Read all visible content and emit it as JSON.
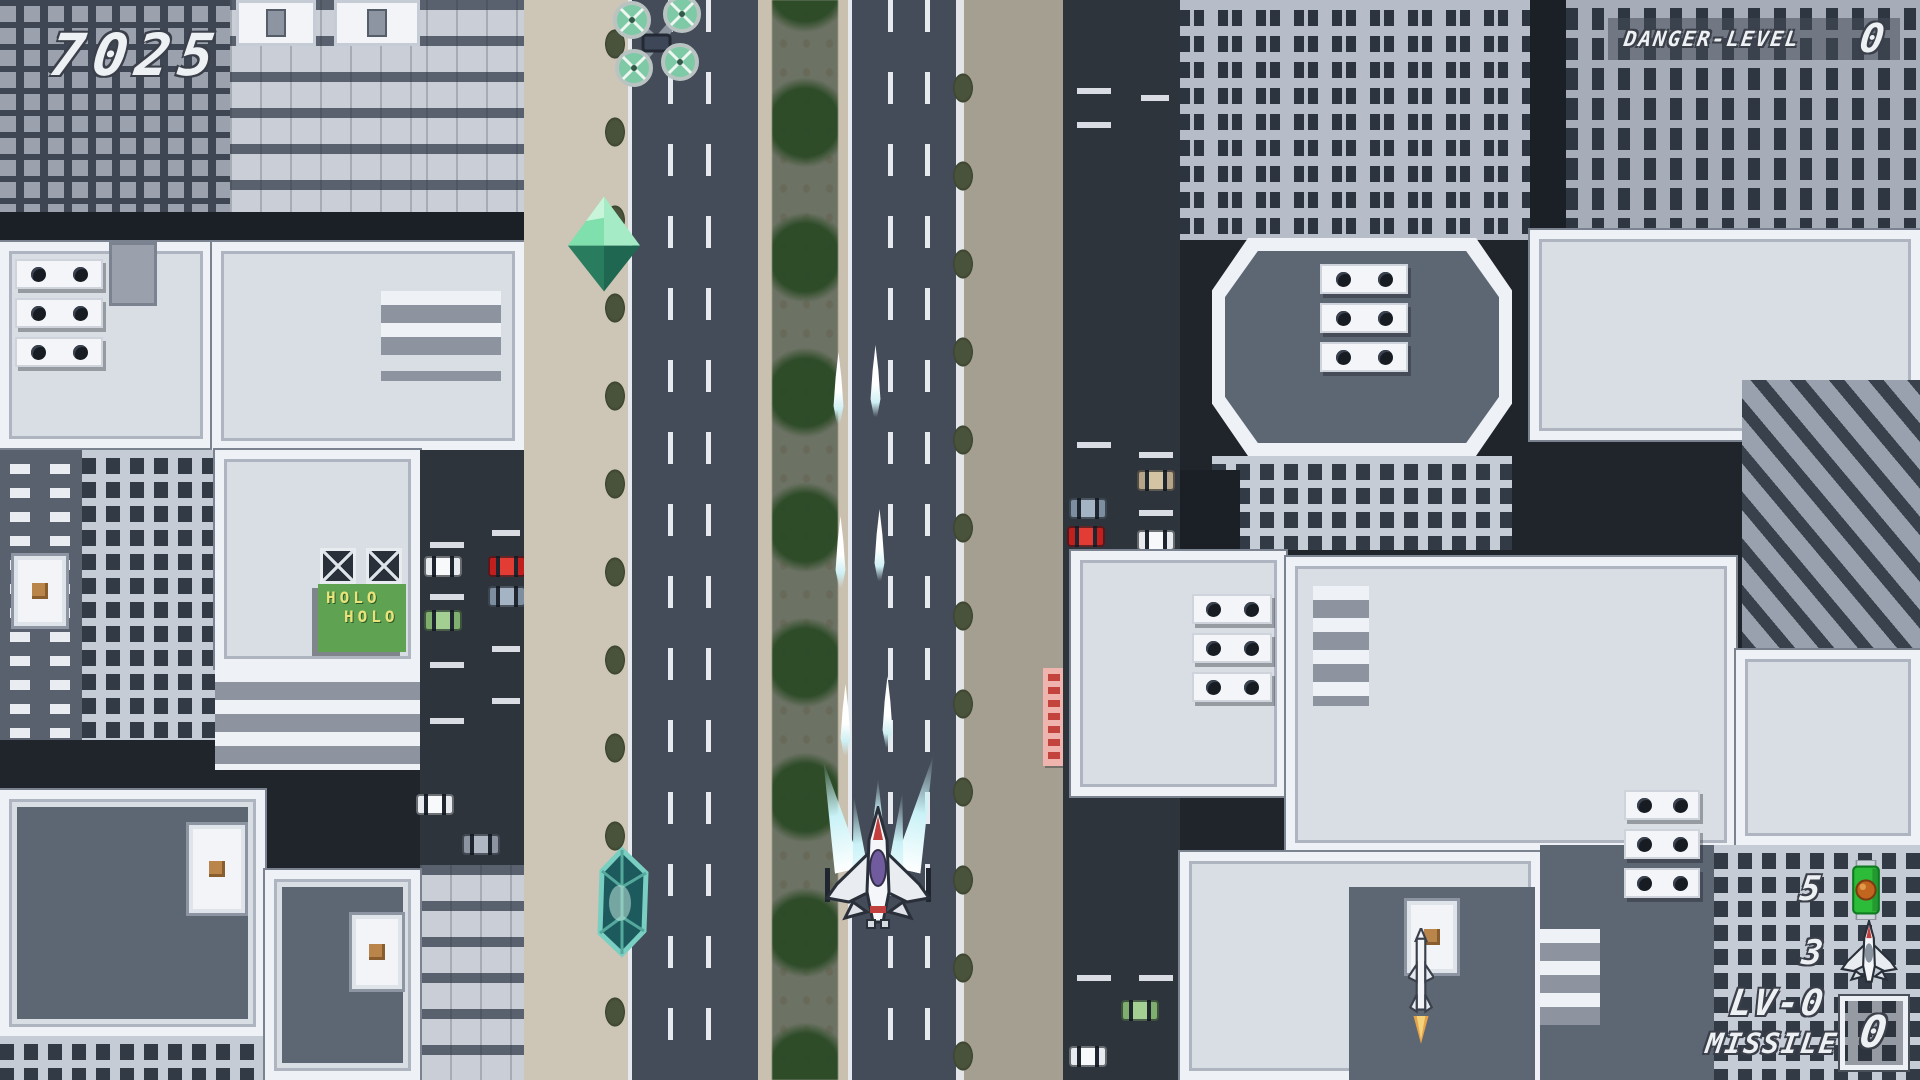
{
  "hud": {
    "score": "7025",
    "danger": {
      "label": "DANGER-LEVEL",
      "value": "0"
    },
    "bottom_right": {
      "count_top": "5",
      "count_bottom": "3",
      "level_label": "LV-0",
      "missile_label": "MISSILE",
      "missile_count": "0"
    }
  },
  "billboard": {
    "line1": "HOLO",
    "line2": "HOLO"
  },
  "entities": {
    "player_ship": "white-fighter-ship",
    "enemy_drone": "green-quad-rotor-drone",
    "green_gem": "green-octahedron-pickup",
    "teal_crystal": "teal-crystal-pickup",
    "battery_item": "green-battery-power-up",
    "missile": "white-missile-with-flame",
    "player_shots": "paired-cyan-white-bullets"
  },
  "palette": {
    "road": "#454c59",
    "sidewalk_left": "#cdc5b5",
    "sidewalk_right": "#a59f91",
    "median_green": "#6c7264",
    "tree_green": "#2b4a26",
    "building_light": "#c6ccd6",
    "building_dark": "#3f4653",
    "roof_border": "#eef1f5",
    "roof_slate": "#5d6673",
    "hud_text": "#eef1f4",
    "billboard_green": "#5fa352",
    "billboard_text": "#e9e37a",
    "sign_red": "#c2443c",
    "exhaust_cyan": "#c9f2f7",
    "ship_accent_red": "#c13f3c",
    "canopy_purple": "#6f5b9e"
  }
}
